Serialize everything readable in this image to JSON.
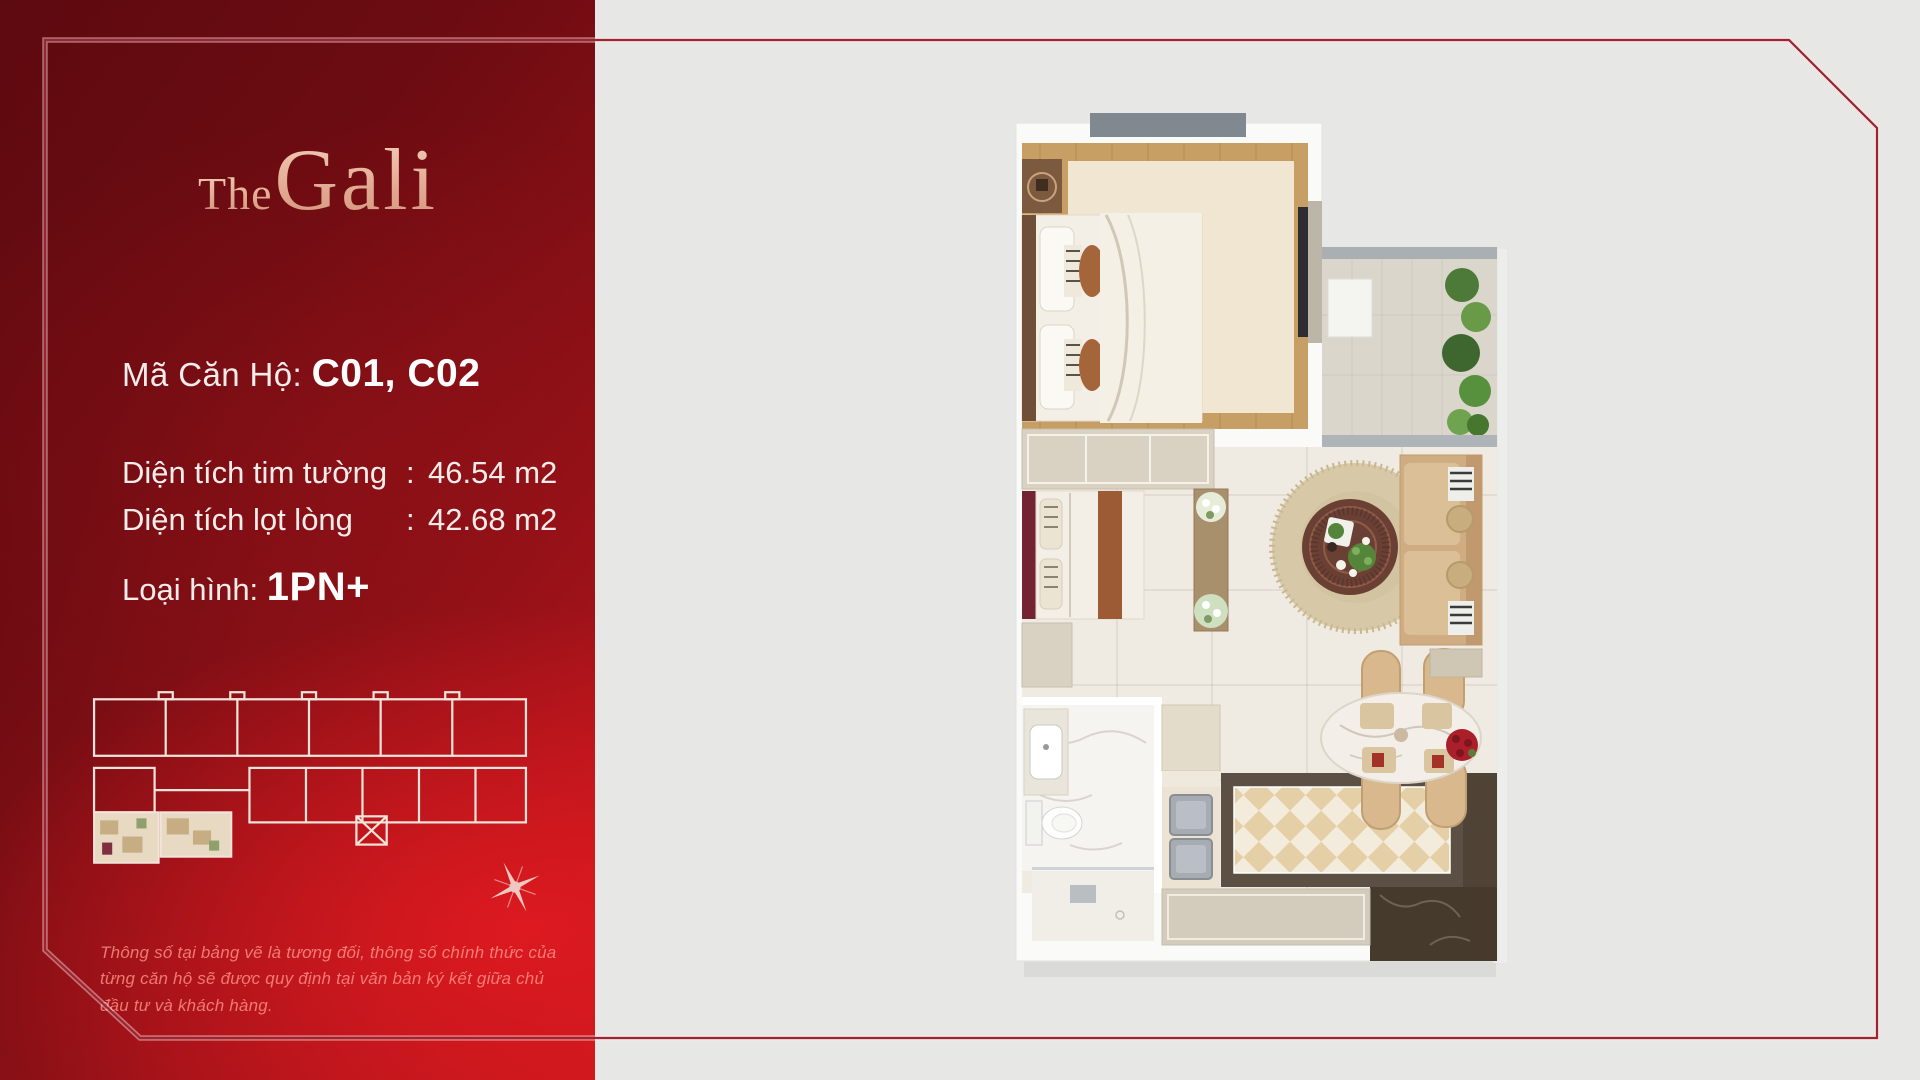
{
  "background": "#e7e7e5",
  "brand": {
    "prefix": "The",
    "name": "Gali"
  },
  "unit": {
    "code_label": "Mã Căn Hộ: ",
    "code_value": "C01, C02"
  },
  "areas": {
    "rows": [
      {
        "label": "Diện tích tim tường",
        "separator": ":",
        "value": "46.54 m2"
      },
      {
        "label": "Diện tích lọt lòng",
        "separator": ":",
        "value": "42.68 m2"
      }
    ]
  },
  "type": {
    "label": "Loại hình: ",
    "value": "1PN+"
  },
  "disclaimer": {
    "text": "Thông số tại bảng vẽ là tương đối, thông số chính thức của từng căn hộ sẽ được quy định tại văn bản ký kết giữa chủ đầu tư và khách hàng."
  },
  "colors": {
    "panel_dark": "#5d0a10",
    "panel_bright": "#c4171e",
    "panel_text": "#f6ecea",
    "logo_gold": "#e3ab93",
    "frame_line": "#9b2533",
    "page_background": "#e7e7e5",
    "key_plan_line": "#f2e4da",
    "highlight_unit_fill": "#e8dac2"
  }
}
